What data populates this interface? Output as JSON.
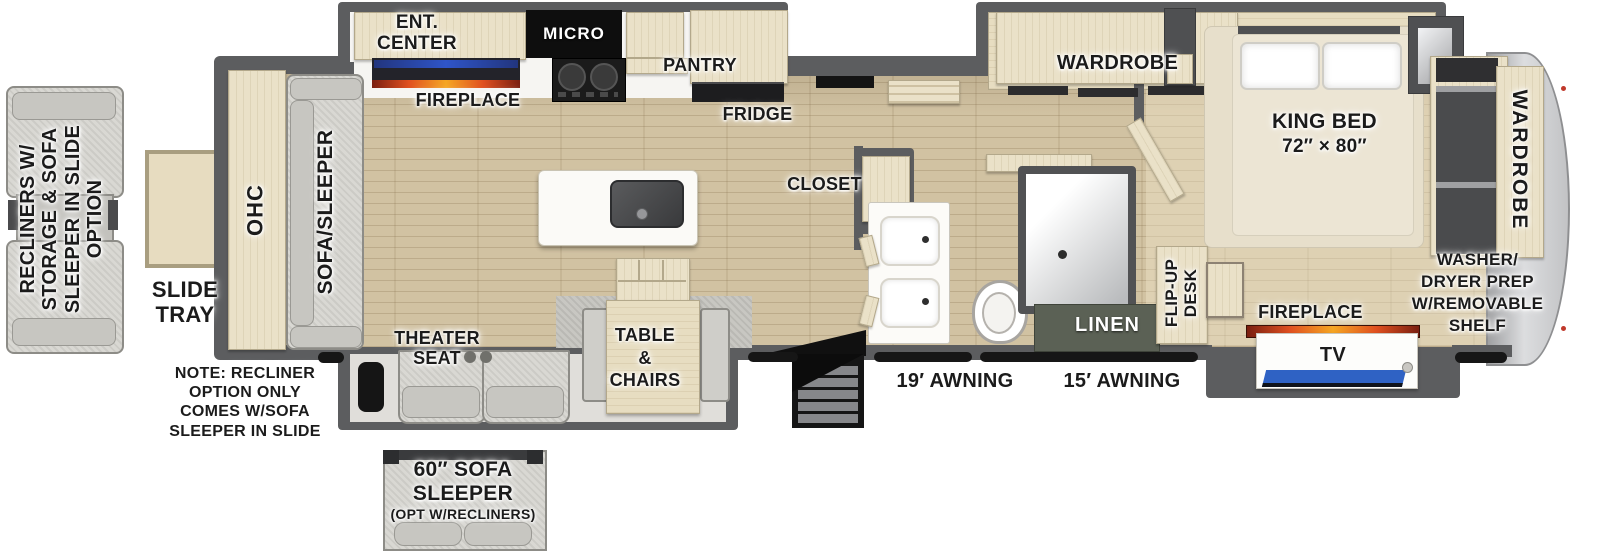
{
  "labels": {
    "recliner_option": [
      "RECLINERS W/",
      "STORAGE & SOFA",
      "SLEEPER IN SLIDE",
      "OPTION"
    ],
    "slide_tray": [
      "SLIDE",
      "TRAY"
    ],
    "ohc": "OHC",
    "sofa_sleeper": "SOFA/SLEEPER",
    "ent_center": [
      "ENT.",
      "CENTER"
    ],
    "fireplace_front": "FIREPLACE",
    "micro": "MICRO",
    "pantry": "PANTRY",
    "fridge": "FRIDGE",
    "closet": "CLOSET",
    "theater_seat": [
      "THEATER",
      "SEAT"
    ],
    "table_chairs": [
      "TABLE",
      "&",
      "CHAIRS"
    ],
    "note": [
      "NOTE: RECLINER",
      "OPTION ONLY",
      "COMES W/SOFA",
      "SLEEPER IN SLIDE"
    ],
    "sofa_option": [
      "60″ SOFA",
      "SLEEPER",
      "(OPT W/RECLINERS)"
    ],
    "awning_19": "19′ AWNING",
    "awning_15": "15′ AWNING",
    "linen": "LINEN",
    "flip_up_desk": [
      "FLIP-UP",
      "DESK"
    ],
    "wardrobe_bedroom": "WARDROBE",
    "king_bed": [
      "KING BED",
      "72″ × 80″"
    ],
    "wardrobe_rear": "WARDROBE",
    "washer_dryer": [
      "WASHER/",
      "DRYER PREP",
      "W/REMOVABLE",
      "SHELF"
    ],
    "fireplace_bedroom": "FIREPLACE",
    "tv": "TV"
  },
  "colors": {
    "wall": "#5c5d5f",
    "floor_wood": "#d1c2a2",
    "cabinet": "#eae1c8",
    "furniture": "#d9d8d3",
    "tv_screen": "#2f62c4",
    "flame": "#f07f2a",
    "linen_bg": "#5b6155",
    "micro_bg": "#0e0e0e"
  }
}
